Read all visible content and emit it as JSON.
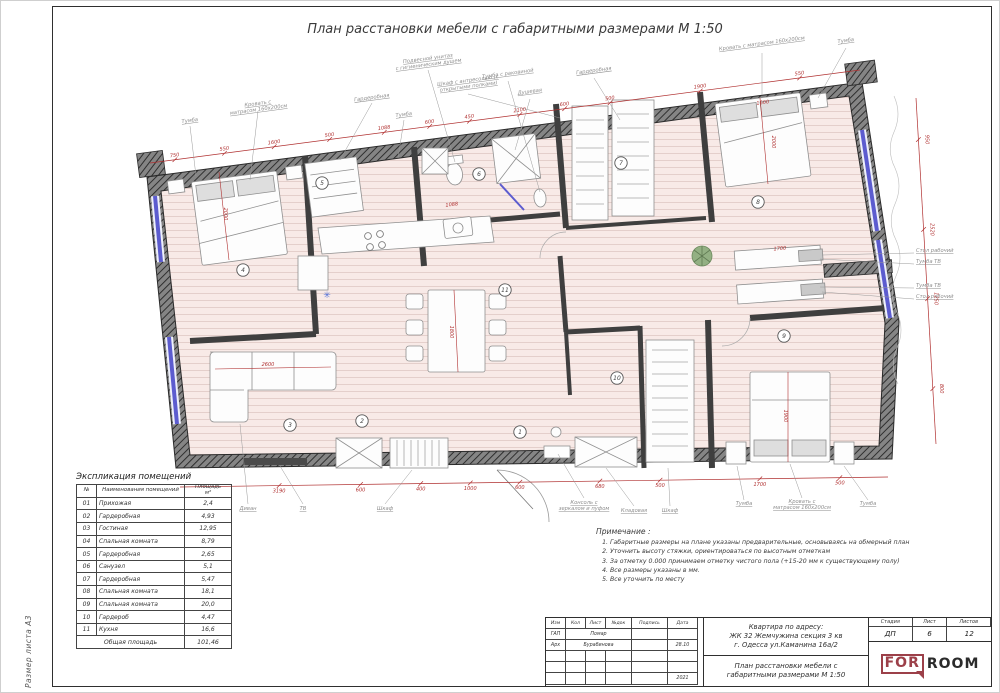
{
  "sheet": {
    "title": "План расстановки мебели с габаритными размерами М 1:50",
    "size_label": "Размер листа А3"
  },
  "explication": {
    "title": "Экспликация помещений",
    "col_num": "№",
    "col_name": "Наименования помещений",
    "col_area_1": "Площадь",
    "col_area_2": "м²",
    "rows": [
      [
        "01",
        "Прихожая",
        "2,4"
      ],
      [
        "02",
        "Гардеробная",
        "4,93"
      ],
      [
        "03",
        "Гостиная",
        "12,95"
      ],
      [
        "04",
        "Спальная комната",
        "8,79"
      ],
      [
        "05",
        "Гардеробная",
        "2,65"
      ],
      [
        "06",
        "Санузел",
        "5,1"
      ],
      [
        "07",
        "Гардеробная",
        "5,47"
      ],
      [
        "08",
        "Спальная комната",
        "18,1"
      ],
      [
        "09",
        "Спальная комната",
        "20,0"
      ],
      [
        "10",
        "Гардероб",
        "4,47"
      ],
      [
        "11",
        "Кухня",
        "16,6"
      ]
    ],
    "total_label": "Общая площадь",
    "total_value": "101,46"
  },
  "notes": {
    "title": "Примечание :",
    "items": [
      "Габаритные размеры на плане указаны предварительные, основываясь на обмерный план",
      "Уточнить высоту стяжки, ориентироваться по высотным отметкам",
      "За отметку 0.000 принимаем отметку чистого пола (+15-20 мм к существующему полу)",
      "Все размеры указаны в мм.",
      "Все уточнить по месту"
    ]
  },
  "titleblock": {
    "cols": [
      "Изм",
      "Кол",
      "Лист",
      "№док",
      "Подпись",
      "Дата"
    ],
    "rows": [
      {
        "role": "ГАП",
        "name": "Помар",
        "date": ""
      },
      {
        "role": "Арх",
        "name": "Бурабинова",
        "date": "28.10"
      }
    ],
    "year": "2021",
    "address": [
      "Квартира по адресу:",
      "ЖК 32 Жемчужина секция 3 кв",
      "г. Одесса ул.Каманина 16а/2"
    ],
    "doc_title": [
      "План расстановки мебели с",
      "габаритными размерами М 1:50"
    ],
    "stage_label": "Стадия",
    "sheet_label": "Лист",
    "sheets_label": "Листов",
    "stage": "ДП",
    "sheet_num": "6",
    "sheets_total": "12",
    "logo": {
      "for": "FOR",
      "room": "ROOM"
    }
  },
  "plan": {
    "room_numbers": [
      "1",
      "2",
      "3",
      "4",
      "5",
      "6",
      "7",
      "8",
      "9",
      "10",
      "11"
    ],
    "labels_top": [
      "Тумба",
      "Кровать с матрасом 160х200см",
      "Гардеробная",
      "Тумба",
      "Шкаф с антресолью (с открытыми полками)",
      "Подвесной унитаз с гигиеническим душем",
      "Тумба с раковиной",
      "Душевая",
      "Гардеробная",
      "Кровать с матрасом 160х200см",
      "Тумба"
    ],
    "labels_right": [
      "Стол рабочий",
      "Тумба ТВ",
      "Тумба ТВ",
      "Стол рабочий"
    ],
    "labels_bottom": [
      "Диван",
      "ТВ",
      "Шкаф",
      "Консоль с зеркалом и пуфом",
      "Кладовая",
      "Шкаф",
      "Тумба",
      "Кровать с матрасом 160х200см",
      "Тумба"
    ],
    "dims_top": [
      "750",
      "550",
      "1600",
      "500",
      "1088",
      "600",
      "450",
      "2100",
      "600",
      "500",
      "1900",
      "550"
    ],
    "dims_bottom": [
      "3190",
      "600",
      "400",
      "1000",
      "600",
      "680",
      "500",
      "1700",
      "500"
    ],
    "dims_right": [
      "950",
      "2520",
      "1250",
      "800"
    ],
    "dims_interior": [
      "2600",
      "2000",
      "1600",
      "2000",
      "1900",
      "1800",
      "1700",
      "1088"
    ]
  },
  "colors": {
    "dimension_red": "#b03030",
    "window_blue": "#5c5ccf",
    "wall_dark": "#4a4a4a",
    "floor_pink": "#f8eae7",
    "logo_maroon": "#9c4049"
  }
}
